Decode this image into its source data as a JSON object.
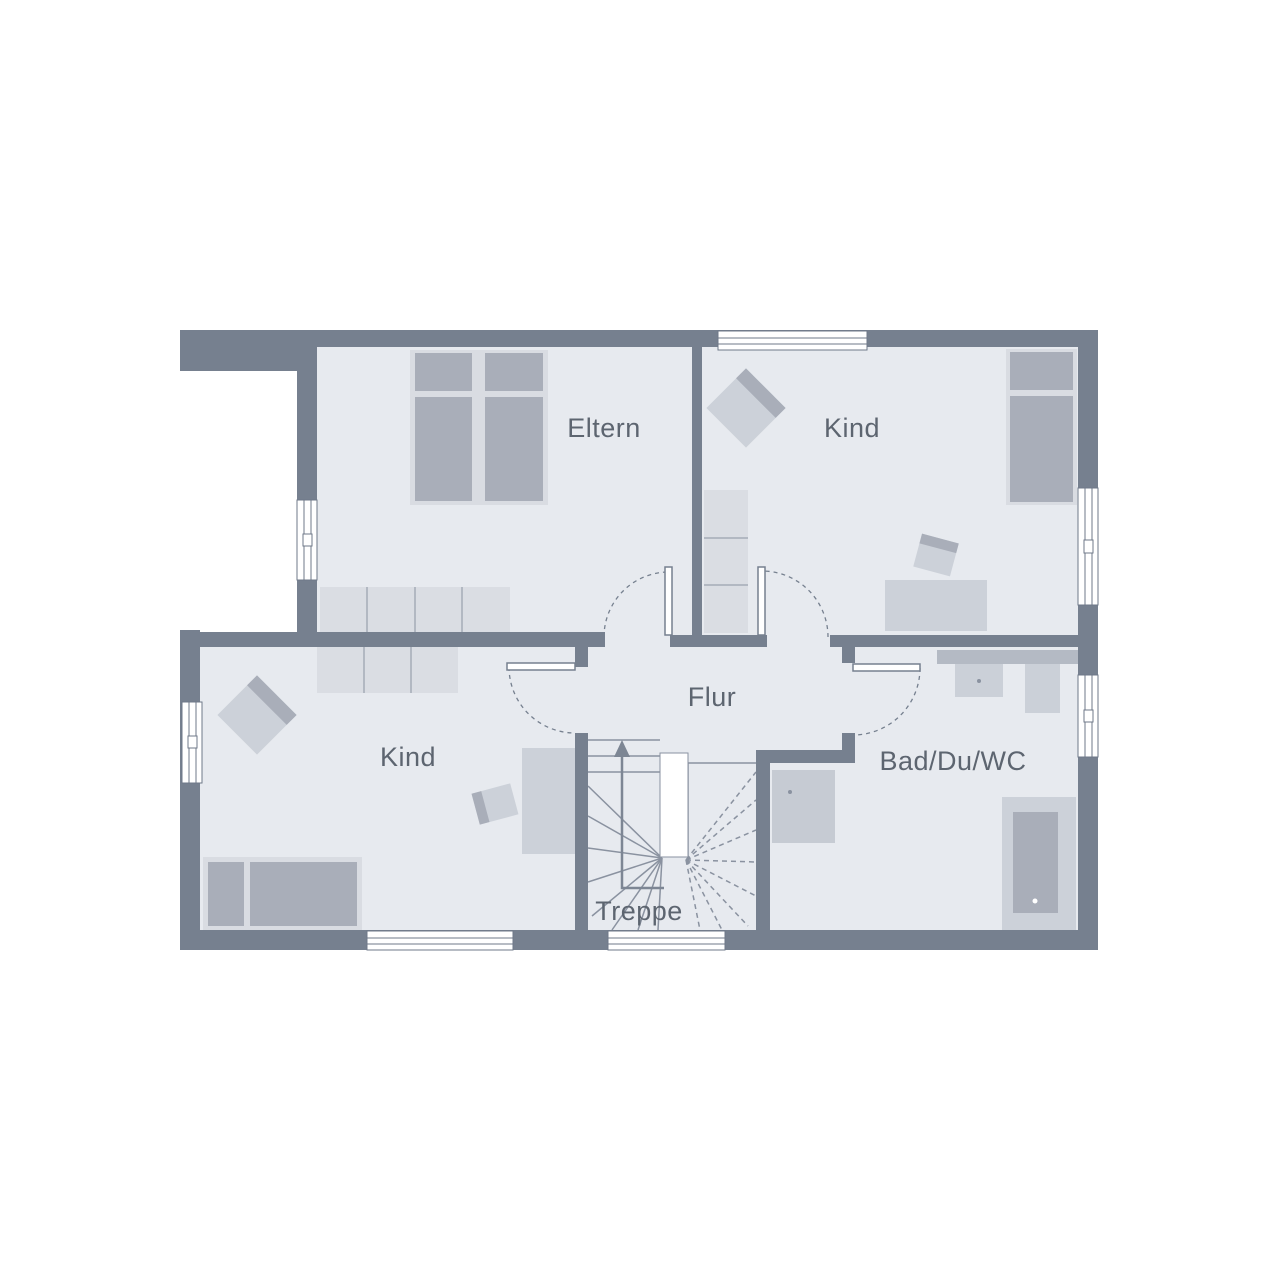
{
  "floorplan": {
    "type": "floor-plan",
    "rooms": [
      {
        "id": "eltern",
        "label": "Eltern"
      },
      {
        "id": "kind-top-right",
        "label": "Kind"
      },
      {
        "id": "kind-bottom-left",
        "label": "Kind"
      },
      {
        "id": "flur",
        "label": "Flur"
      },
      {
        "id": "bad",
        "label": "Bad/Du/WC"
      },
      {
        "id": "treppe",
        "label": "Treppe"
      }
    ],
    "colors": {
      "background": "#ffffff",
      "wall": "#76808f",
      "floor": "#e7eaef",
      "furniture_frame": "#d9dce2",
      "furniture_dark": "#a9aeb9",
      "furniture_mid": "#ccd1d9",
      "wardrobe": "#dadde3",
      "separator": "#b2b8c2",
      "counter": "#b4bac4",
      "fixture": "#cbd0d8",
      "shower": "#c6cbd3",
      "line": "#8a92a0",
      "frame": "#6f7989",
      "arrow": "#7d8694",
      "text": "#5d6570"
    }
  }
}
